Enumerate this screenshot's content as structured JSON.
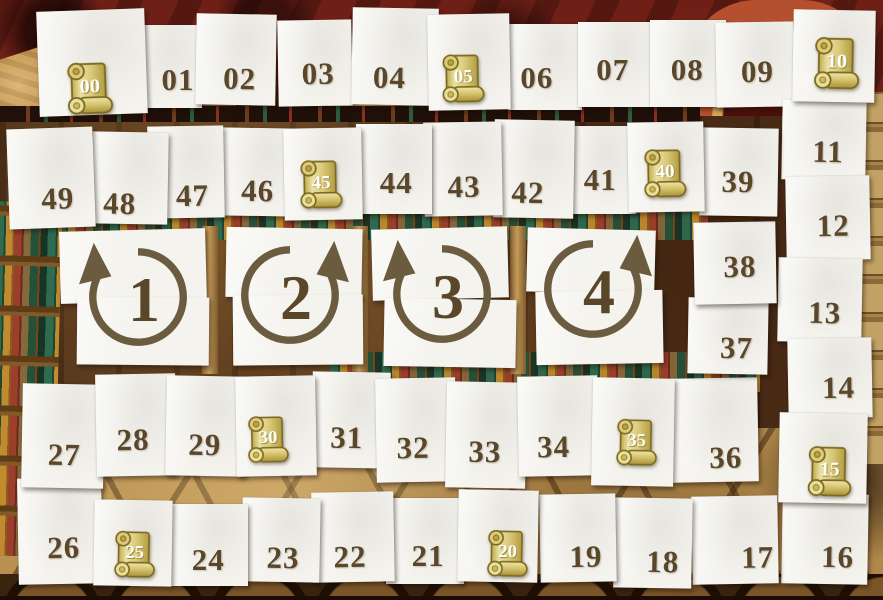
{
  "board": {
    "colors": {
      "card": "#f4f3ee",
      "num": "#5a4629",
      "arrow": "#6b5c40",
      "scroll_body": "#d9c878",
      "scroll_outline": "#7c6a20",
      "scroll_text": "#ffffff",
      "wall": "#6f2016",
      "wood": "#4c2e18",
      "floor": "#b9904f",
      "gold": "#c1924c"
    },
    "tiles": [
      {
        "label": "00",
        "scroll": true,
        "x": 38,
        "y": 10,
        "w": 108,
        "h": 105,
        "rot": -2,
        "nx": 0.47,
        "ny": 0.75,
        "ss": 60
      },
      {
        "label": "01",
        "scroll": false,
        "x": 122,
        "y": 25,
        "w": 80,
        "h": 83,
        "rot": 0,
        "nx": 0.7,
        "ny": 0.66
      },
      {
        "label": "02",
        "scroll": false,
        "x": 196,
        "y": 14,
        "w": 80,
        "h": 91,
        "rot": 1,
        "nx": 0.55,
        "ny": 0.71
      },
      {
        "label": "03",
        "scroll": false,
        "x": 278,
        "y": 20,
        "w": 74,
        "h": 86,
        "rot": -1,
        "nx": 0.54,
        "ny": 0.63
      },
      {
        "label": "04",
        "scroll": false,
        "x": 352,
        "y": 8,
        "w": 86,
        "h": 97,
        "rot": 1,
        "nx": 0.44,
        "ny": 0.72
      },
      {
        "label": "05",
        "scroll": true,
        "x": 428,
        "y": 14,
        "w": 82,
        "h": 96,
        "rot": -1,
        "nx": 0.43,
        "ny": 0.68,
        "ss": 56
      },
      {
        "label": "06",
        "scroll": false,
        "x": 508,
        "y": 24,
        "w": 74,
        "h": 86,
        "rot": 0,
        "nx": 0.39,
        "ny": 0.63
      },
      {
        "label": "07",
        "scroll": false,
        "x": 578,
        "y": 22,
        "w": 74,
        "h": 85,
        "rot": 0,
        "nx": 0.47,
        "ny": 0.56
      },
      {
        "label": "08",
        "scroll": false,
        "x": 650,
        "y": 20,
        "w": 76,
        "h": 87,
        "rot": 0,
        "nx": 0.49,
        "ny": 0.57
      },
      {
        "label": "09",
        "scroll": false,
        "x": 716,
        "y": 22,
        "w": 78,
        "h": 85,
        "rot": -1,
        "nx": 0.53,
        "ny": 0.59
      },
      {
        "label": "10",
        "scroll": true,
        "x": 793,
        "y": 10,
        "w": 82,
        "h": 92,
        "rot": 1,
        "nx": 0.54,
        "ny": 0.59,
        "ss": 60
      },
      {
        "label": "11",
        "scroll": false,
        "x": 782,
        "y": 100,
        "w": 84,
        "h": 80,
        "rot": 1,
        "nx": 0.55,
        "ny": 0.65
      },
      {
        "label": "12",
        "scroll": false,
        "x": 786,
        "y": 176,
        "w": 84,
        "h": 84,
        "rot": -1,
        "nx": 0.56,
        "ny": 0.6
      },
      {
        "label": "13",
        "scroll": false,
        "x": 778,
        "y": 258,
        "w": 84,
        "h": 84,
        "rot": 1,
        "nx": 0.56,
        "ny": 0.66
      },
      {
        "label": "14",
        "scroll": false,
        "x": 788,
        "y": 338,
        "w": 84,
        "h": 80,
        "rot": -1,
        "nx": 0.6,
        "ny": 0.62
      },
      {
        "label": "15",
        "scroll": true,
        "x": 779,
        "y": 413,
        "w": 88,
        "h": 90,
        "rot": 1,
        "nx": 0.58,
        "ny": 0.65,
        "ss": 58
      },
      {
        "label": "16",
        "scroll": false,
        "x": 782,
        "y": 494,
        "w": 86,
        "h": 90,
        "rot": 1,
        "nx": 0.65,
        "ny": 0.7
      },
      {
        "label": "17",
        "scroll": false,
        "x": 692,
        "y": 496,
        "w": 86,
        "h": 88,
        "rot": -1,
        "nx": 0.76,
        "ny": 0.71
      },
      {
        "label": "18",
        "scroll": false,
        "x": 614,
        "y": 498,
        "w": 78,
        "h": 90,
        "rot": 1,
        "nx": 0.63,
        "ny": 0.71
      },
      {
        "label": "19",
        "scroll": false,
        "x": 540,
        "y": 494,
        "w": 76,
        "h": 88,
        "rot": -1,
        "nx": 0.6,
        "ny": 0.72
      },
      {
        "label": "20",
        "scroll": true,
        "x": 458,
        "y": 490,
        "w": 80,
        "h": 92,
        "rot": 1,
        "nx": 0.62,
        "ny": 0.7,
        "ss": 54
      },
      {
        "label": "21",
        "scroll": false,
        "x": 386,
        "y": 498,
        "w": 78,
        "h": 86,
        "rot": 0,
        "nx": 0.54,
        "ny": 0.67
      },
      {
        "label": "22",
        "scroll": false,
        "x": 312,
        "y": 492,
        "w": 82,
        "h": 90,
        "rot": -1,
        "nx": 0.46,
        "ny": 0.72
      },
      {
        "label": "23",
        "scroll": false,
        "x": 242,
        "y": 498,
        "w": 78,
        "h": 84,
        "rot": 1,
        "nx": 0.53,
        "ny": 0.71
      },
      {
        "label": "24",
        "scroll": false,
        "x": 170,
        "y": 504,
        "w": 78,
        "h": 82,
        "rot": 0,
        "nx": 0.49,
        "ny": 0.68
      },
      {
        "label": "25",
        "scroll": true,
        "x": 94,
        "y": 500,
        "w": 78,
        "h": 86,
        "rot": 1,
        "nx": 0.53,
        "ny": 0.64,
        "ss": 54
      },
      {
        "label": "26",
        "scroll": false,
        "x": 18,
        "y": 478,
        "w": 84,
        "h": 106,
        "rot": -1,
        "nx": 0.54,
        "ny": 0.66
      },
      {
        "label": "27",
        "scroll": false,
        "x": 22,
        "y": 384,
        "w": 82,
        "h": 104,
        "rot": 1,
        "nx": 0.52,
        "ny": 0.68
      },
      {
        "label": "28",
        "scroll": false,
        "x": 96,
        "y": 374,
        "w": 80,
        "h": 102,
        "rot": -1,
        "nx": 0.46,
        "ny": 0.65
      },
      {
        "label": "29",
        "scroll": false,
        "x": 166,
        "y": 376,
        "w": 80,
        "h": 100,
        "rot": 1,
        "nx": 0.49,
        "ny": 0.69
      },
      {
        "label": "30",
        "scroll": true,
        "x": 236,
        "y": 376,
        "w": 80,
        "h": 100,
        "rot": -1,
        "nx": 0.4,
        "ny": 0.64,
        "ss": 54
      },
      {
        "label": "31",
        "scroll": false,
        "x": 312,
        "y": 372,
        "w": 78,
        "h": 96,
        "rot": 1,
        "nx": 0.45,
        "ny": 0.69
      },
      {
        "label": "32",
        "scroll": false,
        "x": 376,
        "y": 378,
        "w": 80,
        "h": 104,
        "rot": -1,
        "nx": 0.46,
        "ny": 0.67
      },
      {
        "label": "33",
        "scroll": false,
        "x": 446,
        "y": 382,
        "w": 80,
        "h": 106,
        "rot": 1,
        "nx": 0.49,
        "ny": 0.66
      },
      {
        "label": "34",
        "scroll": false,
        "x": 518,
        "y": 376,
        "w": 80,
        "h": 100,
        "rot": -1,
        "nx": 0.44,
        "ny": 0.71
      },
      {
        "label": "35",
        "scroll": true,
        "x": 592,
        "y": 378,
        "w": 82,
        "h": 108,
        "rot": 1,
        "nx": 0.55,
        "ny": 0.6,
        "ss": 54
      },
      {
        "label": "36",
        "scroll": false,
        "x": 672,
        "y": 378,
        "w": 86,
        "h": 104,
        "rot": -1,
        "nx": 0.62,
        "ny": 0.77
      },
      {
        "label": "37",
        "scroll": false,
        "x": 688,
        "y": 298,
        "w": 80,
        "h": 76,
        "rot": 1,
        "nx": 0.61,
        "ny": 0.66
      },
      {
        "label": "38",
        "scroll": false,
        "x": 694,
        "y": 222,
        "w": 82,
        "h": 82,
        "rot": -1,
        "nx": 0.56,
        "ny": 0.55
      },
      {
        "label": "39",
        "scroll": false,
        "x": 700,
        "y": 128,
        "w": 78,
        "h": 88,
        "rot": 1,
        "nx": 0.49,
        "ny": 0.61
      },
      {
        "label": "40",
        "scroll": true,
        "x": 628,
        "y": 122,
        "w": 76,
        "h": 90,
        "rot": -1,
        "nx": 0.49,
        "ny": 0.58,
        "ss": 56
      },
      {
        "label": "41",
        "scroll": false,
        "x": 560,
        "y": 126,
        "w": 76,
        "h": 88,
        "rot": 0,
        "nx": 0.53,
        "ny": 0.61
      },
      {
        "label": "42",
        "scroll": false,
        "x": 494,
        "y": 120,
        "w": 80,
        "h": 98,
        "rot": 1,
        "nx": 0.43,
        "ny": 0.74
      },
      {
        "label": "43",
        "scroll": false,
        "x": 424,
        "y": 122,
        "w": 78,
        "h": 94,
        "rot": -1,
        "nx": 0.51,
        "ny": 0.69
      },
      {
        "label": "44",
        "scroll": false,
        "x": 356,
        "y": 124,
        "w": 76,
        "h": 90,
        "rot": 0,
        "nx": 0.53,
        "ny": 0.65
      },
      {
        "label": "45",
        "scroll": true,
        "x": 284,
        "y": 128,
        "w": 78,
        "h": 92,
        "rot": -1,
        "nx": 0.47,
        "ny": 0.62,
        "ss": 56
      },
      {
        "label": "46",
        "scroll": false,
        "x": 220,
        "y": 128,
        "w": 76,
        "h": 88,
        "rot": 1,
        "nx": 0.5,
        "ny": 0.72
      },
      {
        "label": "47",
        "scroll": false,
        "x": 148,
        "y": 126,
        "w": 76,
        "h": 92,
        "rot": -1,
        "nx": 0.58,
        "ny": 0.76
      },
      {
        "label": "48",
        "scroll": false,
        "x": 92,
        "y": 132,
        "w": 76,
        "h": 92,
        "rot": 1,
        "nx": 0.37,
        "ny": 0.78
      },
      {
        "label": "49",
        "scroll": false,
        "x": 8,
        "y": 128,
        "w": 86,
        "h": 100,
        "rot": -2,
        "nx": 0.57,
        "ny": 0.71
      }
    ],
    "rounds": [
      {
        "label": "1",
        "dir": "left",
        "top": [
          60,
          230,
          146,
          72,
          -1.5
        ],
        "bottom": [
          77,
          297,
          132,
          68,
          0.5
        ],
        "cx": 138,
        "cy": 297
      },
      {
        "label": "2",
        "dir": "right",
        "top": [
          226,
          228,
          136,
          70,
          1
        ],
        "bottom": [
          233,
          295,
          130,
          70,
          -0.5
        ],
        "cx": 290,
        "cy": 295
      },
      {
        "label": "3",
        "dir": "left",
        "top": [
          372,
          228,
          136,
          71,
          -1.5
        ],
        "bottom": [
          384,
          299,
          132,
          68,
          1
        ],
        "cx": 442,
        "cy": 294
      },
      {
        "label": "4",
        "dir": "right",
        "top": [
          527,
          229,
          128,
          64,
          1.5
        ],
        "bottom": [
          536,
          291,
          127,
          73,
          -1
        ],
        "cx": 593,
        "cy": 289
      }
    ]
  }
}
